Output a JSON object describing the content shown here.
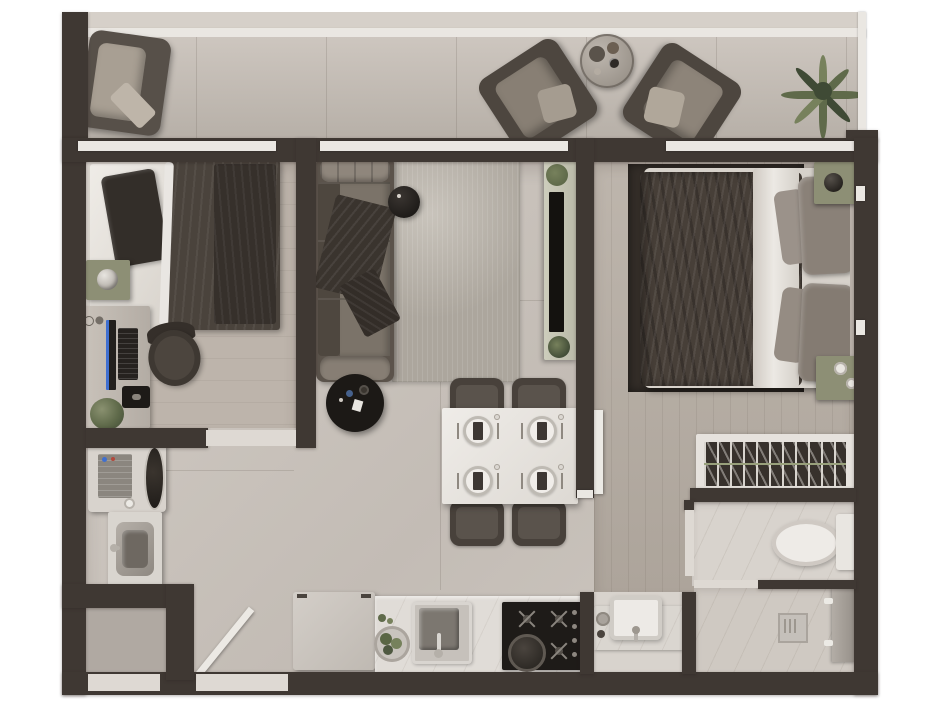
{
  "scene": {
    "kind": "apartment-floor-plan-top-down-render",
    "text_visible": "none"
  },
  "rooms": [
    {
      "name": "balcony",
      "furniture": [
        "lounge-armchair",
        "lounge-armchair",
        "lounge-armchair",
        "round-coffee-table",
        "potted-palm"
      ]
    },
    {
      "name": "bedroom-1",
      "furniture": [
        "single-bed",
        "dark-pillow",
        "dark-blanket",
        "bedside-table-with-decor",
        "desk",
        "monitor",
        "keyboard",
        "mouse-pad",
        "desk-plant",
        "office-chair"
      ]
    },
    {
      "name": "living-room",
      "furniture": [
        "sofa-with-throw",
        "floor-lamp",
        "round-black-coffee-table",
        "area-rug",
        "tv-sideboard",
        "television",
        "sideboard-plants"
      ]
    },
    {
      "name": "dining-area",
      "furniture": [
        "dining-table",
        "place-setting",
        "place-setting",
        "place-setting",
        "place-setting",
        "dining-chair",
        "dining-chair",
        "dining-chair",
        "dining-chair"
      ]
    },
    {
      "name": "kitchen",
      "furniture": [
        "refrigerator",
        "marble-counter",
        "bowl-of-greens",
        "kitchen-sink-with-faucet",
        "four-burner-cooktop",
        "frying-pan"
      ]
    },
    {
      "name": "bedroom-2",
      "furniture": [
        "double-bed",
        "dark-duvet",
        "folded-white-sheet",
        "pillows",
        "dark-rug",
        "nightstand-with-lamp",
        "nightstand-with-decor",
        "open-wardrobe-with-hangers"
      ]
    },
    {
      "name": "bathroom",
      "furniture": [
        "toilet-with-cistern",
        "vanity-basin",
        "shower-drain",
        "shower-column"
      ]
    },
    {
      "name": "laundry",
      "furniture": [
        "washing-machine",
        "utility-sink"
      ]
    },
    {
      "name": "entry",
      "furniture": [
        "open-entry-door",
        "storage-closet"
      ]
    }
  ],
  "palette": {
    "wall": "#3f3833",
    "sill": "#eae7e2",
    "threshold": "#ded9d3",
    "floor_main": "#c8c1ba",
    "floor_bed1": "#bdb4ab",
    "floor_wood": "#b6ada3",
    "floor_balcony": "#c4bdb5",
    "floor_entry": "#b0a9a2",
    "marble_light": "#d8d3cd",
    "marble_dark": "#cfc9c2",
    "rug_living": "#aca69d",
    "rug_bed2": "#332d28",
    "sofa_base": "#5b534b",
    "cushion": "#7b7369",
    "cushion_light": "#8f867c",
    "blanket": "#3a342e",
    "bed_sheet": "#e9e6e2",
    "duvet": "#473f38",
    "pillow_gray": "#8a8178",
    "pillow_dark": "#332e29",
    "green_cabinet": "#8d8f75",
    "plant": "#5f6a4a",
    "plant_dark": "#3f4a35",
    "black": "#1c1916",
    "steel": "#9a948d",
    "chair": "#48413b",
    "table_white": "#eceae5",
    "appliance": "#d8d3cd",
    "cooktop": "#1e1b18",
    "accent_blue": "#3f6fd0",
    "tv_black": "#14120f"
  }
}
